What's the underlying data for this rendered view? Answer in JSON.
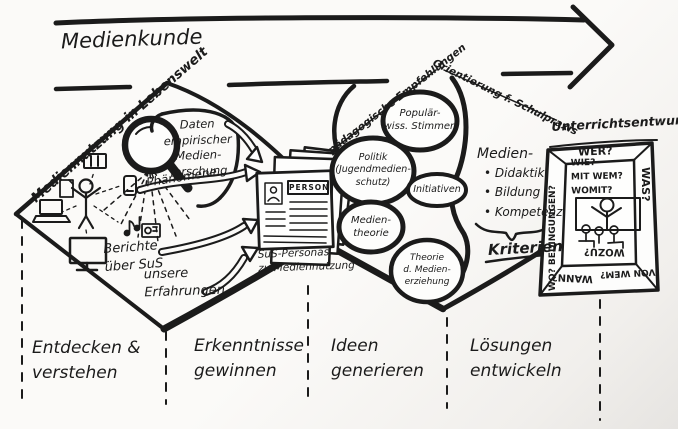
{
  "colors": {
    "ink": "#1b1b1b",
    "paper": "#fbfaf8"
  },
  "top": {
    "arrow_label": "Medienkunde"
  },
  "d1": {
    "edge": "Mediennutzung in Lebenswelt",
    "daten": "Daten\nempirischer\nMedien-\nforschung",
    "phaenomene": "Phänomene",
    "berichte": "Berichte\nüber SuS",
    "erfahrungen": "unsere\nErfahrungen"
  },
  "personas": {
    "card_header": "PERSON",
    "caption": "SuS-Personas\nzu Mediennutzung"
  },
  "d2": {
    "edge_left": "pädagogische Empfehlungen",
    "edge_right": "Orientierung f. Schulpraxis",
    "bubble_popwiss": "Populär-\nwiss. Stimmen",
    "bubble_politik": "Politik\n(Jugendmedien-\nschutz)",
    "bubble_initiativen": "Initiativen",
    "bubble_medientheorie": "Medien-\ntheorie",
    "bubble_theorie": "Theorie\nd. Medien-\nerziehung",
    "medien_heading": "Medien-",
    "medien_items": [
      "Didaktik",
      "Bildung",
      "Kompetenz"
    ],
    "kriterien": "Kriterien"
  },
  "entwurf": {
    "title": "Unterrichtsentwurf",
    "frame_top": "WER?",
    "frame_right": "WAS?",
    "frame_left": "WO? BEDINGUNGEN?",
    "frame_bottom_left": "WANN?",
    "frame_bottom_right": "VON WEM?",
    "inner_questions": "WIE?\nMIT WEM?\nWOMIT?",
    "inner_bottom": "WOZU?"
  },
  "phases": [
    {
      "label": "Entdecken &\nverstehen"
    },
    {
      "label": "Erkenntnisse\ngewinnen"
    },
    {
      "label": "Ideen\ngenerieren"
    },
    {
      "label": "Lösungen\nentwickeln"
    }
  ]
}
